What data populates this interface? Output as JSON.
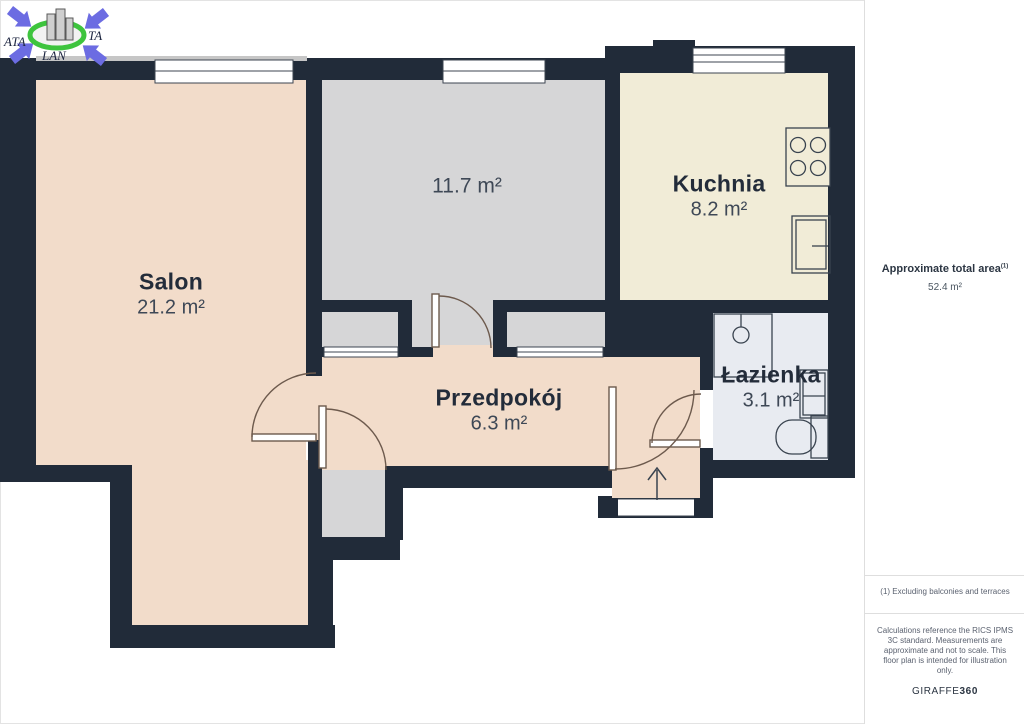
{
  "logo": {
    "text_left": "ATA",
    "text_right": "TA",
    "text_bottom": "LAN"
  },
  "rooms": [
    {
      "name": "Salon",
      "area": "21.2 m²"
    },
    {
      "name": "",
      "area": "11.7 m²"
    },
    {
      "name": "Kuchnia",
      "area": "8.2 m²"
    },
    {
      "name": "Przedpokój",
      "area": "6.3 m²"
    },
    {
      "name": "Łazienka",
      "area": "3.1 m²"
    }
  ],
  "sidebar": {
    "total_area_label": "Approximate total area",
    "total_area_superscript": "(1)",
    "total_area_value": "52.4 m²",
    "footnote": "(1) Excluding balconies and terraces",
    "disclaimer": "Calculations reference the RICS IPMS 3C standard. Measurements are approximate and not to scale. This floor plan is intended for illustration only.",
    "brand_name": "GIRAFFE",
    "brand_suffix": "360"
  },
  "colors": {
    "wall": "#212b39",
    "salon_hallway": "#f2dcca",
    "gray_room": "#d6d6d7",
    "kitchen": "#f1ecd7",
    "bathroom": "#e8ebf1",
    "window_white": "#ffffff",
    "door_stroke": "#6d5a4d",
    "fixture_stroke": "#39434f",
    "logo_blue": "#6c6ce2",
    "logo_green": "#3ec43e"
  }
}
